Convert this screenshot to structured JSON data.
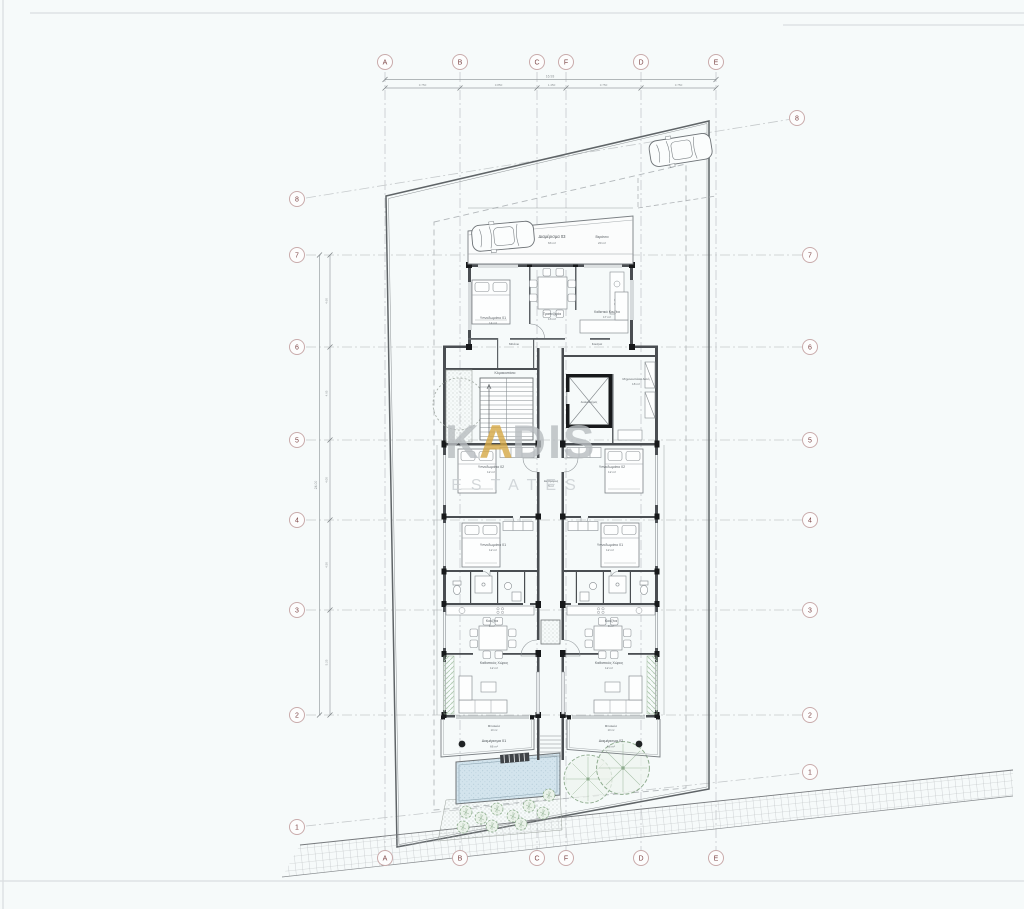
{
  "watermark": {
    "k": "K",
    "a": "A",
    "dis": "DIS",
    "sub": "ESTATES"
  },
  "grid": {
    "columns": [
      "A",
      "B",
      "C",
      "F",
      "D",
      "E"
    ],
    "rows": [
      "8",
      "7",
      "6",
      "5",
      "4",
      "3",
      "2",
      "1"
    ]
  },
  "apartments": {
    "apt03": {
      "name": "Διαμέρισμα 03",
      "area": "63 m²"
    },
    "apt01": {
      "name": "Διαμέρισμα 01",
      "area": "66 m²"
    },
    "apt02": {
      "name": "Διαμέρισμα 02",
      "area": "66 m²"
    }
  },
  "rooms": {
    "veranda": "Βεράντα",
    "veranda03_area": "20 m²",
    "bedroom_top": "Υπνοδωμάτιο 01",
    "bedroom_top_area": "14 m²",
    "dining_top": "Τραπεζαρία",
    "dining_top_area": "13 m²",
    "living_top": "Καθιστικό Κουζίνα",
    "living_top_area": "17 m²",
    "bath": "Μπάνιο",
    "kitchen": "Κουζίνα",
    "kitchen_area": "8 m²",
    "stairs": "Κλιμακοστάσιο",
    "elevator": "Ανελκυστήρας",
    "machine": "Μηχανοστάσιο Αυλή",
    "machine_area": "18 m²",
    "corridor": "Διάδρομος",
    "corridor_area": "5 m²",
    "bedroom02": "Υπνοδωμάτιο 02",
    "bedroom02_area": "12 m²",
    "bedroom01": "Υπνοδωμάτιο 01",
    "bedroom01_area": "12 m²",
    "living": "Καθιστικός Χώρος",
    "living_area": "12 m²",
    "balcony": "Μπαλκόνι",
    "balcony_area": "10 m²"
  },
  "dims": {
    "top_total": "16.93",
    "top": [
      "3.750",
      "3.850",
      "1.450",
      "3.750",
      "3.750"
    ],
    "left": [
      "4.60",
      "4.65",
      "4.00",
      "4.50",
      "5.25"
    ],
    "left_total": "24.00"
  }
}
